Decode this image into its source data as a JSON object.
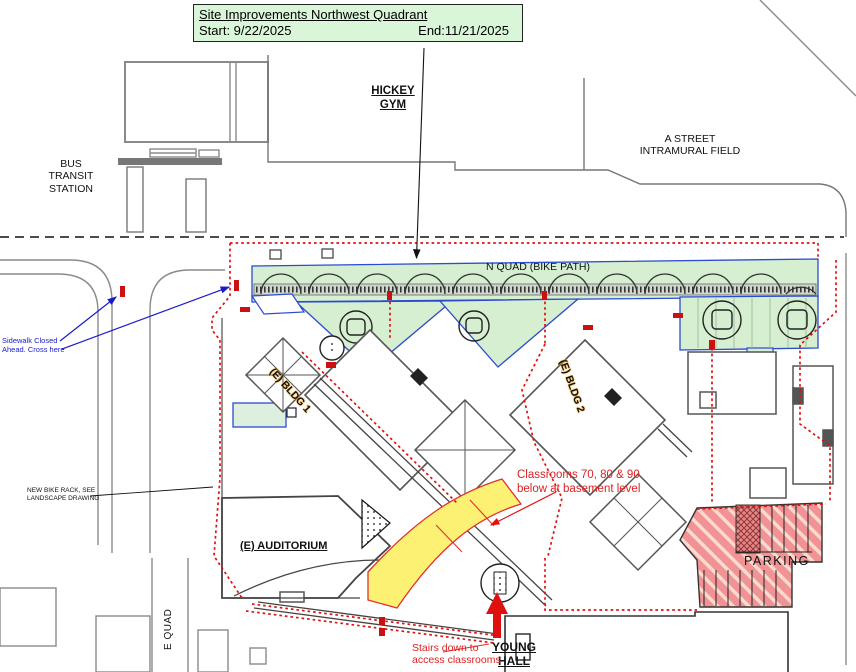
{
  "title_box": {
    "title": "Site Improvements Northwest Quadrant",
    "start_label": "Start: 9/22/2025",
    "end_label": "End:11/21/2025"
  },
  "labels": {
    "hickey_gym": "HICKEY\nGYM",
    "a_street": "A STREET\nINTRAMURAL FIELD",
    "bus_transit": "BUS\nTRANSIT\nSTATION",
    "n_quad": "N QUAD (BIKE PATH)",
    "e_bldg_1": "(E) BLDG 1",
    "e_bldg_2": "(E) BLDG 2",
    "e_auditorium": "(E) AUDITORIUM",
    "young_hall": "YOUNG\nHALL",
    "parking": "PARKING",
    "e_quad": "E QUAD",
    "classrooms_note": "Classrooms 70, 80 & 90\nbelow at basement level",
    "stairs_note": "Stairs down to\naccess classrooms",
    "sidewalk_note": "Sidewalk Closed\nAhead. Cross here",
    "bike_rack_note": "NEW BIKE RACK, SEE\nLANDSCAPE DRAWING"
  },
  "colors": {
    "title_green": "#d9f6d9",
    "area_green": "#d5efd0",
    "highlight_yellow": "#fdf173",
    "parking_red": "#f19394",
    "fence_red": "#e01010",
    "note_red": "#dd2222",
    "note_blue": "#1a1acc",
    "area_outline_blue": "#2b4bd0"
  }
}
